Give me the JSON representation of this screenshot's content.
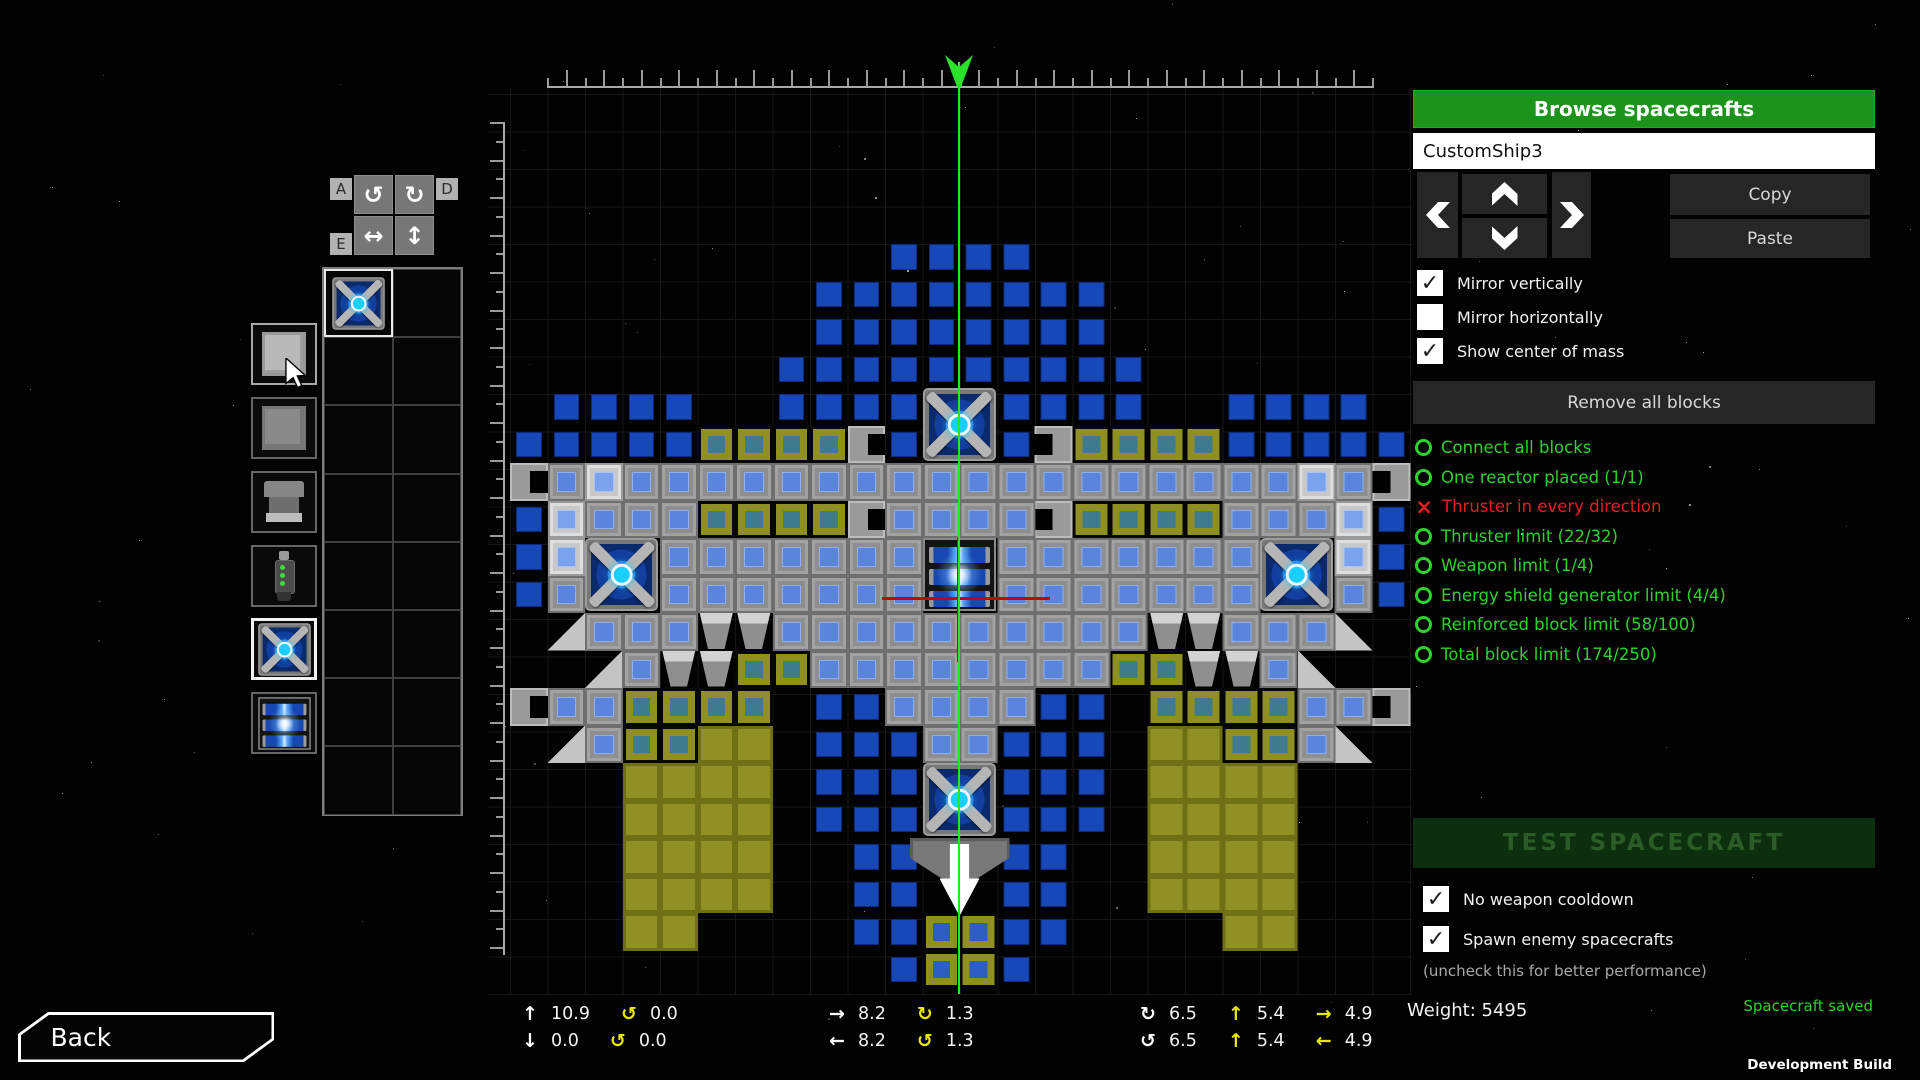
{
  "window": {
    "dev_build": "Development Build"
  },
  "tools": {
    "keys": [
      "A",
      "D",
      "E",
      "W"
    ],
    "buttons": [
      {
        "name": "rotate-ccw",
        "icon": "↺"
      },
      {
        "name": "rotate-cw",
        "icon": "↻"
      },
      {
        "name": "flip-horizontal",
        "icon": "↔"
      },
      {
        "name": "flip-vertical",
        "icon": "↕"
      }
    ]
  },
  "palette": {
    "items": [
      {
        "name": "hull-block"
      },
      {
        "name": "reinforced-block"
      },
      {
        "name": "thruster"
      },
      {
        "name": "weapon-gun"
      },
      {
        "name": "energy-shield-generator"
      },
      {
        "name": "reactor"
      }
    ],
    "selected_index": 4,
    "hovered_index": 0
  },
  "inventory": {
    "cols": 2,
    "rows": 8,
    "cells": [
      {
        "row": 0,
        "col": 0,
        "item": "energy-shield-generator",
        "selected": true
      }
    ]
  },
  "builder": {
    "ship_map": [
      "..........bb",
      "........bbbb",
      "........bbbb",
      ".......bbbbb",
      ".bbbb..bbbb.",
      "bbbbbtttteb.",
      "ealaaaaaaaaa",
      "blaaatttteaa",
      "bl..aaaaaaa.",
      "ba..aaaaaaa.",
      ".uaaannaaaaa",
      "..uannttaaaa",
      "eaatttt.bbaa",
      ".uattyy.bbba",
      "...yyyy.bbb.",
      "...yyyy.bbb.",
      "...yyyy..bb.",
      "...yyyy..bb.",
      "...yy....bbY",
      "..........bY"
    ],
    "features": [
      {
        "type": "shield",
        "col": 11,
        "row": 4,
        "center": true
      },
      {
        "type": "shield",
        "col": 2,
        "row": 8,
        "mirror": true
      },
      {
        "type": "reactor",
        "col": 11,
        "row": 8,
        "center": true
      },
      {
        "type": "shield",
        "col": 11,
        "row": 14,
        "center": true
      },
      {
        "type": "engine",
        "col": 11,
        "row": 16,
        "center": true
      }
    ],
    "legend": {
      "b": "blue-block",
      "a": "armored-hull",
      "l": "light-hull",
      "h": "hull",
      "t": "thruster-olive",
      "y": "olive-block",
      "Y": "olive-armored",
      "n": "engine-nozzle",
      "e": "side-nozzle",
      "u": "hull-wedge"
    },
    "colors": {
      "block_blue": "#1848b8",
      "hull_gray": "#8e8e8e",
      "olive": "#8f8f22",
      "shield_blue": "#2f7de8",
      "axis_green": "#2be32b",
      "com_red": "#c40000"
    }
  },
  "panel": {
    "browse_button": "Browse spacecrafts",
    "ship_name": "CustomShip3",
    "copy": "Copy",
    "paste": "Paste",
    "checkboxes": [
      {
        "label": "Mirror vertically",
        "checked": true
      },
      {
        "label": "Mirror horizontally",
        "checked": false
      },
      {
        "label": "Show center of mass",
        "checked": true
      }
    ],
    "remove_all": "Remove all blocks",
    "checklist": [
      {
        "text": "Connect all blocks",
        "status": "ok"
      },
      {
        "text": "One reactor placed (1/1)",
        "status": "ok"
      },
      {
        "text": "Thruster in every direction",
        "status": "fail"
      },
      {
        "text": "Thruster limit (22/32)",
        "status": "ok"
      },
      {
        "text": "Weapon limit (1/4)",
        "status": "ok"
      },
      {
        "text": "Energy shield generator limit (4/4)",
        "status": "ok"
      },
      {
        "text": "Reinforced block limit (58/100)",
        "status": "ok"
      },
      {
        "text": "Total block limit (174/250)",
        "status": "ok"
      }
    ],
    "test_button": "TEST SPACECRAFT",
    "test_checkboxes": [
      {
        "label": "No weapon cooldown",
        "checked": true
      },
      {
        "label": "Spawn enemy spacecrafts",
        "checked": true
      }
    ],
    "note": "(uncheck this for better performance)",
    "colors": {
      "accent_green": "#1c941c",
      "ok_green": "#2ed22e",
      "error_red": "#e02020",
      "saved_green": "#27d427"
    }
  },
  "status": {
    "weight_label": "Weight:",
    "weight_value": "5495",
    "saved_message": "Spacecraft saved"
  },
  "stats": {
    "groups": [
      {
        "rows": [
          [
            {
              "icon": "arrow-up",
              "color": "white",
              "value": "10.9"
            },
            {
              "icon": "rot-ccw",
              "color": "yellow",
              "value": "0.0"
            }
          ],
          [
            {
              "icon": "arrow-down",
              "color": "white",
              "value": "0.0"
            },
            {
              "icon": "rot-ccw",
              "color": "yellow",
              "value": "0.0"
            }
          ]
        ]
      },
      {
        "rows": [
          [
            {
              "icon": "arrow-right",
              "color": "white",
              "value": "8.2"
            },
            {
              "icon": "rot-cw",
              "color": "yellow",
              "value": "1.3"
            }
          ],
          [
            {
              "icon": "arrow-left",
              "color": "white",
              "value": "8.2"
            },
            {
              "icon": "rot-ccw",
              "color": "yellow",
              "value": "1.3"
            }
          ]
        ]
      },
      {
        "rows": [
          [
            {
              "icon": "rot-cw",
              "color": "white",
              "value": "6.5"
            },
            {
              "icon": "arrow-up",
              "color": "yellow",
              "value": "5.4"
            },
            {
              "icon": "arrow-right",
              "color": "yellow",
              "value": "4.9"
            }
          ],
          [
            {
              "icon": "rot-ccw",
              "color": "white",
              "value": "6.5"
            },
            {
              "icon": "arrow-up",
              "color": "yellow",
              "value": "5.4"
            },
            {
              "icon": "arrow-left",
              "color": "yellow",
              "value": "4.9"
            }
          ]
        ]
      }
    ]
  },
  "back_button": {
    "label": "Back"
  }
}
